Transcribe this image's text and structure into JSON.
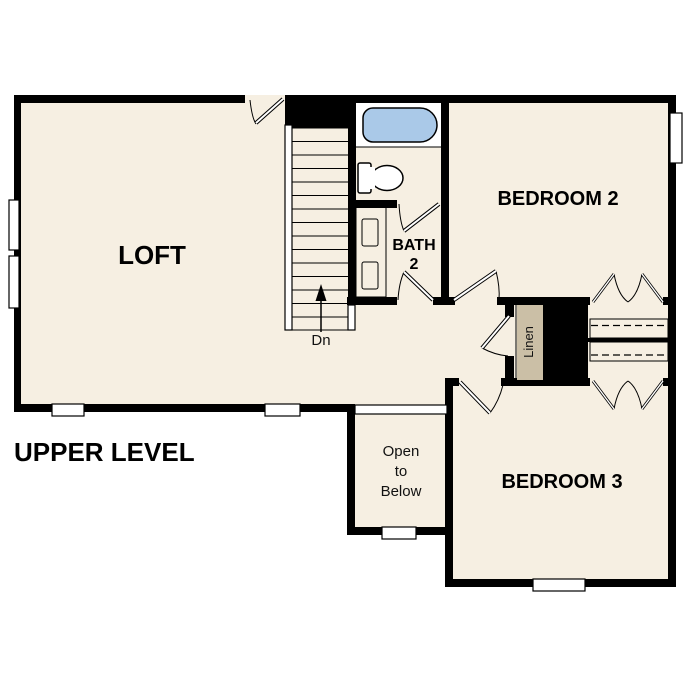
{
  "title": "UPPER LEVEL",
  "labels": {
    "loft": "LOFT",
    "bath_line1": "BATH",
    "bath_line2": "2",
    "bedroom2": "BEDROOM 2",
    "bedroom3": "BEDROOM 3",
    "linen": "Linen",
    "stairs_direction": "Dn",
    "open_line1": "Open",
    "open_line2": "to",
    "open_line3": "Below"
  },
  "colors": {
    "floor": "#f6efe2",
    "wall": "#000000",
    "fixture_blue": "#aac9e8",
    "cabinet_tan": "#cbbfa6",
    "window_white": "#ffffff"
  }
}
